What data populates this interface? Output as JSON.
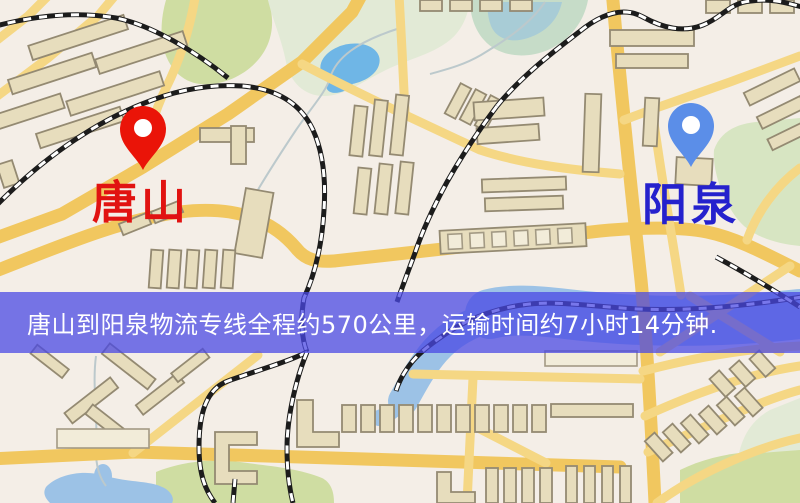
{
  "banner": {
    "text": "唐山到阳泉物流专线全程约570公里，运输时间约7小时14分钟.",
    "background": "rgba(73,71,228,0.74)",
    "text_color": "#ffffff",
    "distance_km": "570",
    "duration": "7小时14分钟"
  },
  "markers": {
    "origin": {
      "label": "唐山",
      "label_color": "#e11311",
      "pin_color": "#ea1408"
    },
    "destination": {
      "label": "阳泉",
      "label_color": "#2521cd",
      "pin_color": "#5b8ee8"
    }
  },
  "map": {
    "colors": {
      "background": "#f4eee7",
      "road_major": "#f1c75f",
      "road_minor": "#f5d784",
      "railway": "#1c1c1c",
      "water": "#9cc2e6",
      "lake": "#6fb6e6",
      "park": "#cfdda2",
      "building_fill": "#e7ddbd",
      "building_stroke": "#948a72"
    }
  }
}
